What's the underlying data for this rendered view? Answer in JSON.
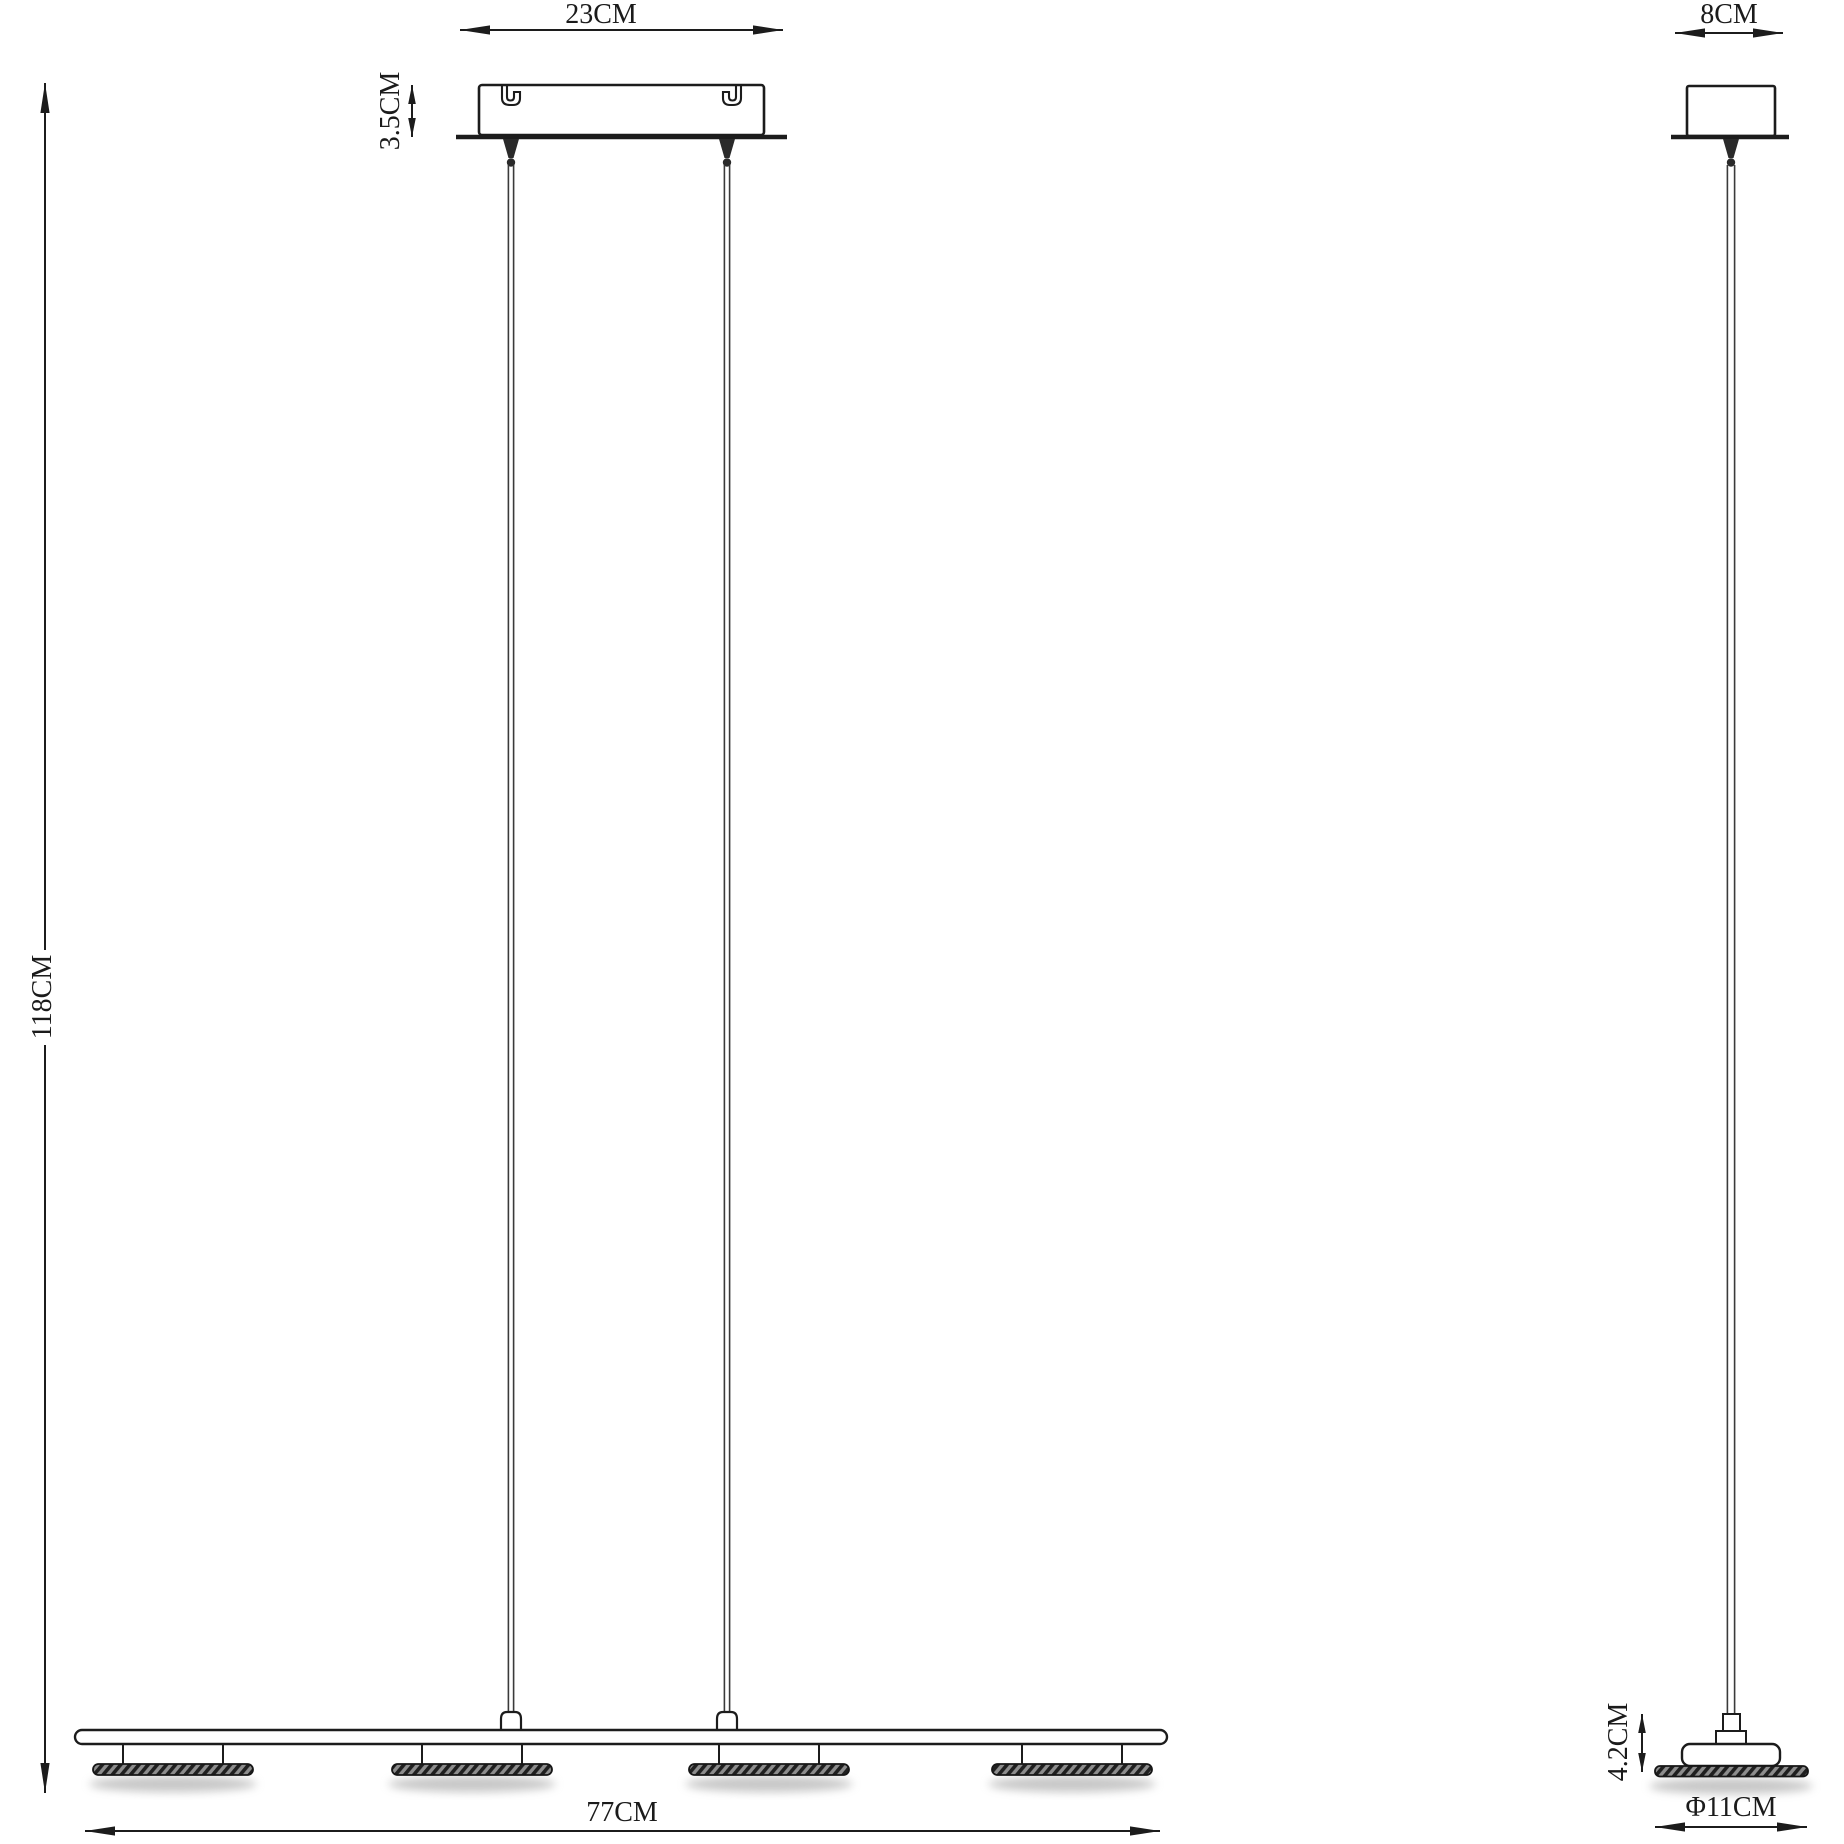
{
  "front_view": {
    "canopy_width_label": "23CM",
    "canopy_height_label": "3.5CM",
    "overall_height_label": "118CM",
    "bar_length_label": "77CM",
    "lamp_head_count": 4,
    "suspension_cable_count": 2
  },
  "side_view": {
    "canopy_depth_label": "8CM",
    "head_height_label": "4.2CM",
    "head_diameter_label": "Φ11CM",
    "suspension_cable_count": 1
  },
  "style": {
    "line_color": "#1c1c1c",
    "background_color": "#ffffff",
    "shadow_color": "#8f8f8f"
  }
}
